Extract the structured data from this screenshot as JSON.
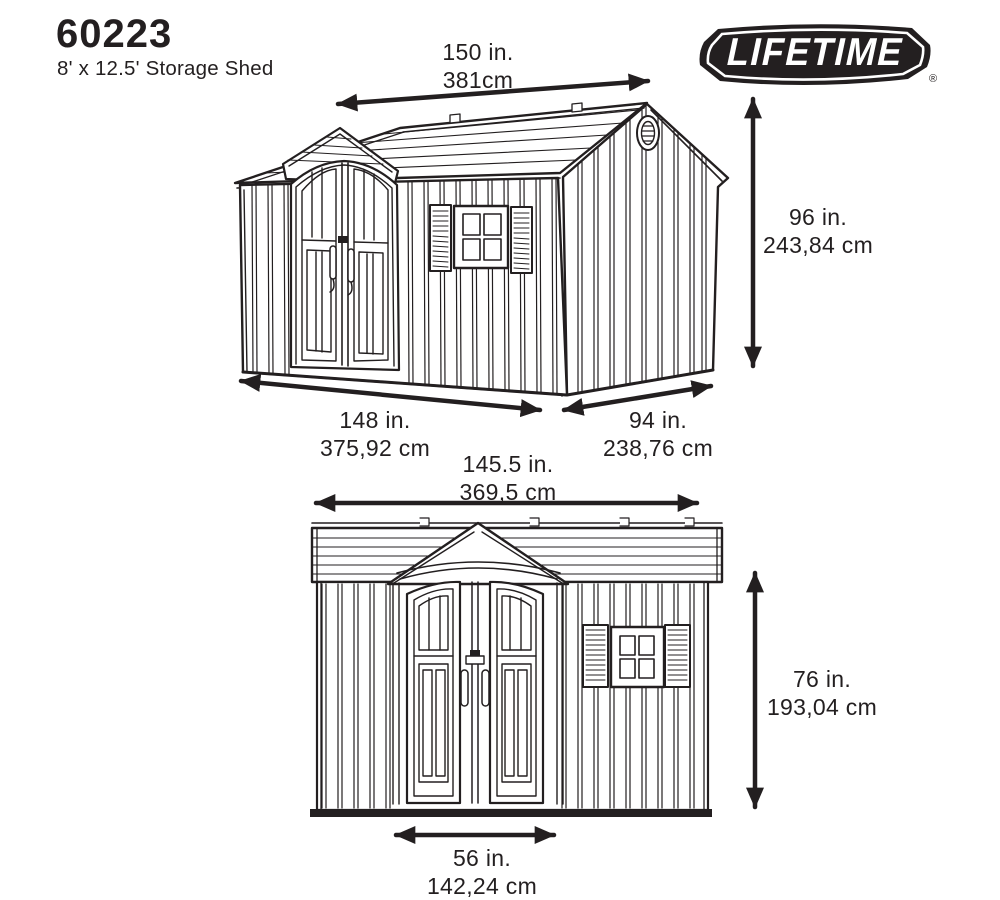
{
  "header": {
    "model_number": "60223",
    "product_name": "8' x 12.5' Storage Shed"
  },
  "logo": {
    "brand": "LIFETIME",
    "registered_mark": "®",
    "banner_color": "#231f20",
    "text_color": "#ffffff"
  },
  "colors": {
    "line": "#231f20",
    "background": "#ffffff"
  },
  "perspective_view": {
    "description": "three-quarter perspective drawing of storage shed",
    "dims": {
      "roof_width": {
        "in": "150 in.",
        "cm": "381cm"
      },
      "height": {
        "in": "96 in.",
        "cm": "243,84 cm"
      },
      "front_width": {
        "in": "148 in.",
        "cm": "375,92 cm"
      },
      "side_depth": {
        "in": "94 in.",
        "cm": "238,76 cm"
      }
    }
  },
  "front_view": {
    "description": "front elevation drawing of storage shed",
    "dims": {
      "width": {
        "in": "145.5 in.",
        "cm": "369,5 cm"
      },
      "height": {
        "in": "76 in.",
        "cm": "193,04 cm"
      },
      "door_width": {
        "in": "56 in.",
        "cm": "142,24 cm"
      }
    }
  }
}
